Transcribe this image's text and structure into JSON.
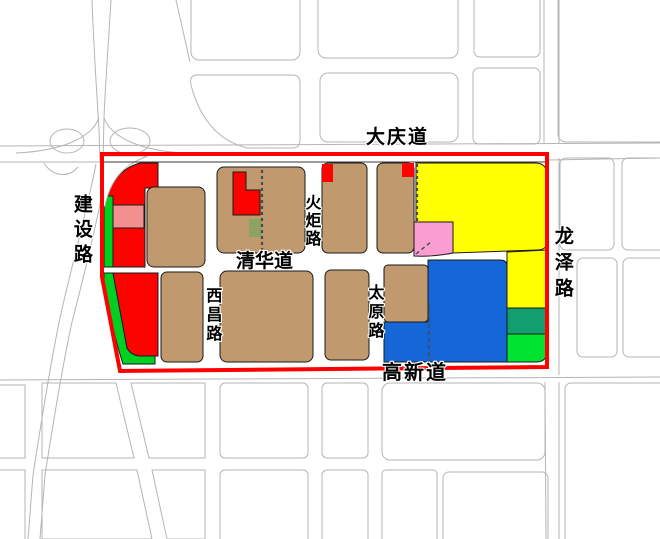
{
  "map": {
    "roads": {
      "daqing": "大庆道",
      "gaoxin": "高新道",
      "qinghua": "清华道",
      "jianshe": "建设路",
      "longze": "龙泽路",
      "huoju": "火炬路",
      "xichang": "西昌路",
      "taiyuan": "太原路"
    },
    "palette": {
      "boundary": "#ff0000",
      "tan": "#c09a6e",
      "red": "#fb0400",
      "yellow": "#ffff00",
      "blue": "#1566d6",
      "pink": "#fa9ed2",
      "salmon": "#f29090",
      "green": "#00d020",
      "lime": "#00e331",
      "teal": "#129e6f",
      "olive": "#8fa263",
      "road_gray": "#b5b5b5"
    }
  }
}
